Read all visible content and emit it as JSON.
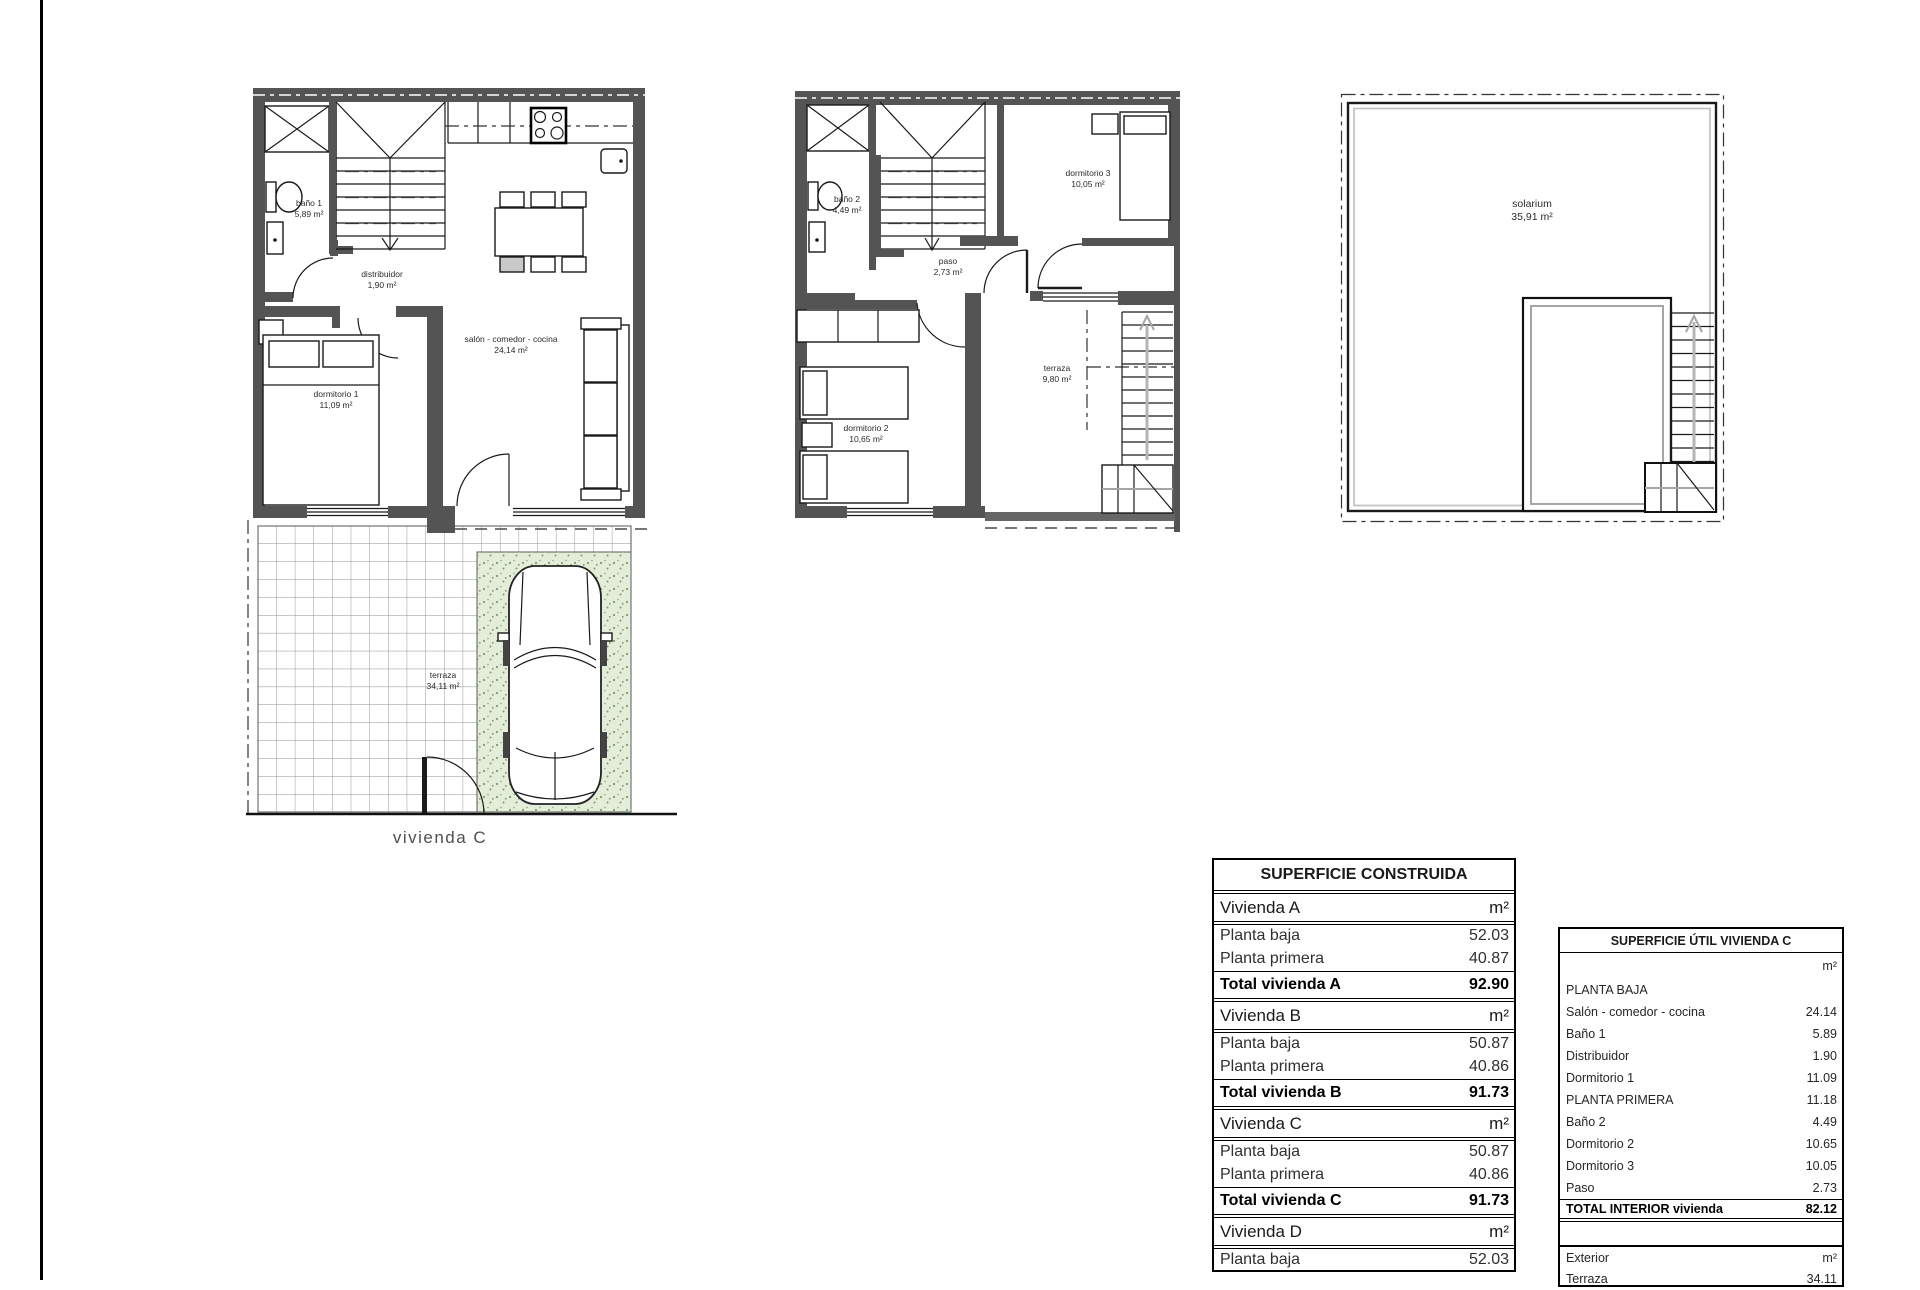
{
  "colors": {
    "wall": "#545454",
    "parking_green": "#e3edd8",
    "tile_grid": "#8f8f8f"
  },
  "plans": {
    "ground": {
      "caption": "vivienda C",
      "rooms": {
        "bano1": {
          "name": "baño 1",
          "area": "5,89 m²"
        },
        "distribuidor": {
          "name": "distribuidor",
          "area": "1,90 m²"
        },
        "salon": {
          "name": "salón - comedor - cocina",
          "area": "24,14 m²"
        },
        "dormitorio1": {
          "name": "dormitorio 1",
          "area": "11,09 m²"
        },
        "terraza": {
          "name": "terraza",
          "area": "34,11 m²"
        }
      }
    },
    "first": {
      "rooms": {
        "bano2": {
          "name": "baño 2",
          "area": "4,49 m²"
        },
        "dormitorio3": {
          "name": "dormitorio 3",
          "area": "10,05 m²"
        },
        "paso": {
          "name": "paso",
          "area": "2,73 m²"
        },
        "dormitorio2": {
          "name": "dormitorio 2",
          "area": "10,65 m²"
        },
        "terraza": {
          "name": "terraza",
          "area": "9,80 m²"
        }
      }
    },
    "roof": {
      "rooms": {
        "solarium": {
          "name": "solarium",
          "area": "35,91 m²"
        }
      }
    }
  },
  "tables": {
    "construida": {
      "title": "SUPERFICIE CONSTRUIDA",
      "rows": [
        {
          "label": "Vivienda A",
          "value": "m²"
        },
        {
          "label": "Planta baja",
          "value": "52.03"
        },
        {
          "label": "Planta primera",
          "value": "40.87"
        },
        {
          "label": "Total vivienda A",
          "value": "92.90"
        },
        {
          "label": "Vivienda B",
          "value": "m²"
        },
        {
          "label": "Planta baja",
          "value": "50.87"
        },
        {
          "label": "Planta primera",
          "value": "40.86"
        },
        {
          "label": "Total vivienda B",
          "value": "91.73"
        },
        {
          "label": "Vivienda C",
          "value": "m²"
        },
        {
          "label": "Planta baja",
          "value": "50.87"
        },
        {
          "label": "Planta primera",
          "value": "40.86"
        },
        {
          "label": "Total vivienda C",
          "value": "91.73"
        },
        {
          "label": "Vivienda D",
          "value": "m²"
        },
        {
          "label": "Planta baja",
          "value": "52.03"
        }
      ]
    },
    "util": {
      "title": "SUPERFICIE ÚTIL VIVIENDA C",
      "rows": [
        {
          "label": "",
          "value": "m²"
        },
        {
          "label": "PLANTA BAJA",
          "value": ""
        },
        {
          "label": "Salón - comedor - cocina",
          "value": "24.14"
        },
        {
          "label": "Baño 1",
          "value": "5.89"
        },
        {
          "label": "Distribuidor",
          "value": "1.90"
        },
        {
          "label": "Dormitorio 1",
          "value": "11.09"
        },
        {
          "label": "PLANTA PRIMERA",
          "value": "11.18"
        },
        {
          "label": "Baño 2",
          "value": "4.49"
        },
        {
          "label": "Dormitorio 2",
          "value": "10.65"
        },
        {
          "label": "Dormitorio 3",
          "value": "10.05"
        },
        {
          "label": "Paso",
          "value": "2.73"
        },
        {
          "label": "TOTAL INTERIOR vivienda",
          "value": "82.12"
        },
        {
          "label": "Exterior",
          "value": "m²"
        },
        {
          "label": "Terraza",
          "value": "34.11"
        }
      ]
    }
  }
}
